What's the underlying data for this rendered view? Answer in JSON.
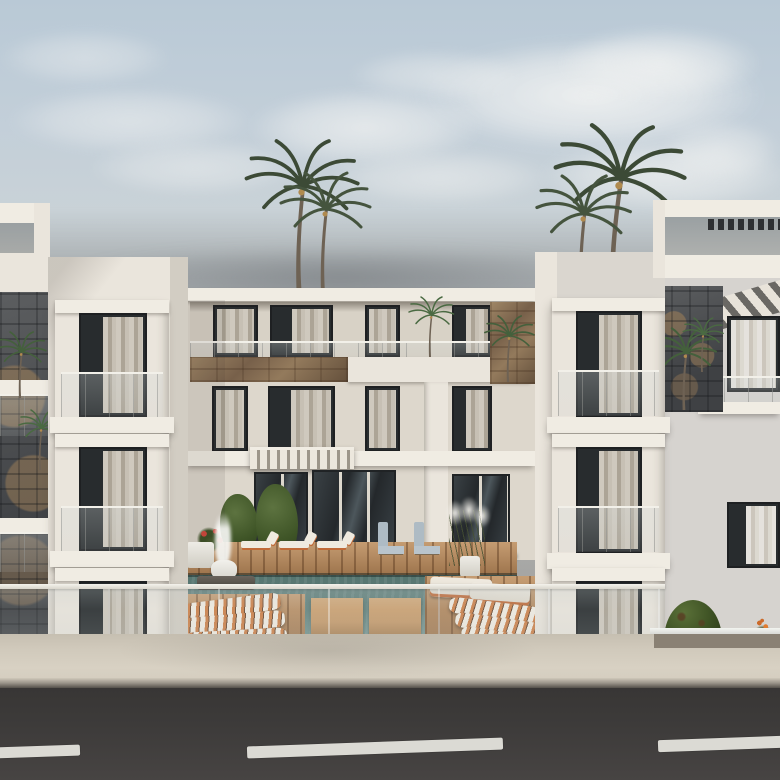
{
  "meta": {
    "type": "architectural-exterior-render",
    "description": "Daytime 3D rendering: modern white three-storey apartment complex with twin balcony towers flanking a central block, rooftop pergolas, stone accent walls, palm trees, central swimming-pool courtyard with wood decks, sun loungers and a fountain, fronted by a glass balustrade, concrete sidewalk and asphalt road with dashed lane markings."
  },
  "scene": {
    "sky": {
      "clouds": 10,
      "horizon_haze": true
    },
    "vegetation": {
      "tall_palms": 4,
      "small_palms": 7,
      "round_bushes": 1,
      "pampas_grass": 1,
      "potted_plants": 2,
      "flower_beds": 3
    },
    "buildings": {
      "left_tower": {
        "floors": 3,
        "balconies": 3,
        "roof_pergola_opening": true
      },
      "center_block": {
        "floors": 3,
        "windows_top_floor": 4,
        "windows_middle_floor": 4,
        "entrance_canopy": true,
        "stone_parapet": true
      },
      "right_tower": {
        "floors": 3,
        "balconies": 3,
        "roof_pergola_opening": true,
        "pergola_slats": true
      },
      "right_wing": {
        "windows": 2,
        "striped_awning": true,
        "stone_accent_wall": true,
        "ground_planter": true
      }
    },
    "pool_area": {
      "swimming_pool": true,
      "fountain": true,
      "back_row_loungers_white": 3,
      "back_row_loungers_grey": 2,
      "striped_wave_loungers": 6,
      "flat_loungers": 2,
      "daybed_platforms": 2,
      "wood_deck_sections": 3
    },
    "street": {
      "glass_balustrade": true,
      "sidewalk": true,
      "curb": true,
      "asphalt_road": true,
      "lane_markings": 3
    }
  },
  "palette": {
    "sky_top": "#b9c9d6",
    "sky_mid": "#cdd4d6",
    "sky_low": "#a6a6a4",
    "cloud_white": "#f2f3f2",
    "haze_grey": "#8f9398",
    "wall_lit": "#eae5dc",
    "wall_mid": "#ddd7cc",
    "wall_cool": "#d6d3cf",
    "slab_white": "#f0ece3",
    "ceiling_shadow": "#8f887d",
    "window_frame": "#1e2022",
    "window_glass": "#282c2e",
    "curtain_light": "#d8d1c5",
    "curtain_mid": "#b3aa9b",
    "rail_highlight": "#f2f0e9",
    "stone_tan": "#8a7154",
    "stone_dark": "#4b4d50",
    "pool_deep": "#4f6e68",
    "pool_teal": "#5d7d78",
    "pool_light": "#7a9a95",
    "wood_deck": "#b5875a",
    "wood_platform": "#c59a6b",
    "lounger_white": "#efeadf",
    "lounger_orange": "#c06a38",
    "lounger_grey": "#aebbc4",
    "stripe_orange": "#cd8048",
    "palm_green": "#3c4a36",
    "palm_green_light": "#44603c",
    "palm_trunk": "#6e6254",
    "plant_green": "#3f5527",
    "bush_green": "#3e5224",
    "flower_red": "#c2453a",
    "flower_orange": "#cc6a2a",
    "awning_dark": "#6a6864",
    "sidewalk": "#d0c9bb",
    "curb_dark": "#55514b",
    "road_asphalt": "#3d3b3a",
    "lane_white": "#dbdad4",
    "planter_soil": "#8a8174",
    "lamp_white": "#f6f6f2"
  }
}
